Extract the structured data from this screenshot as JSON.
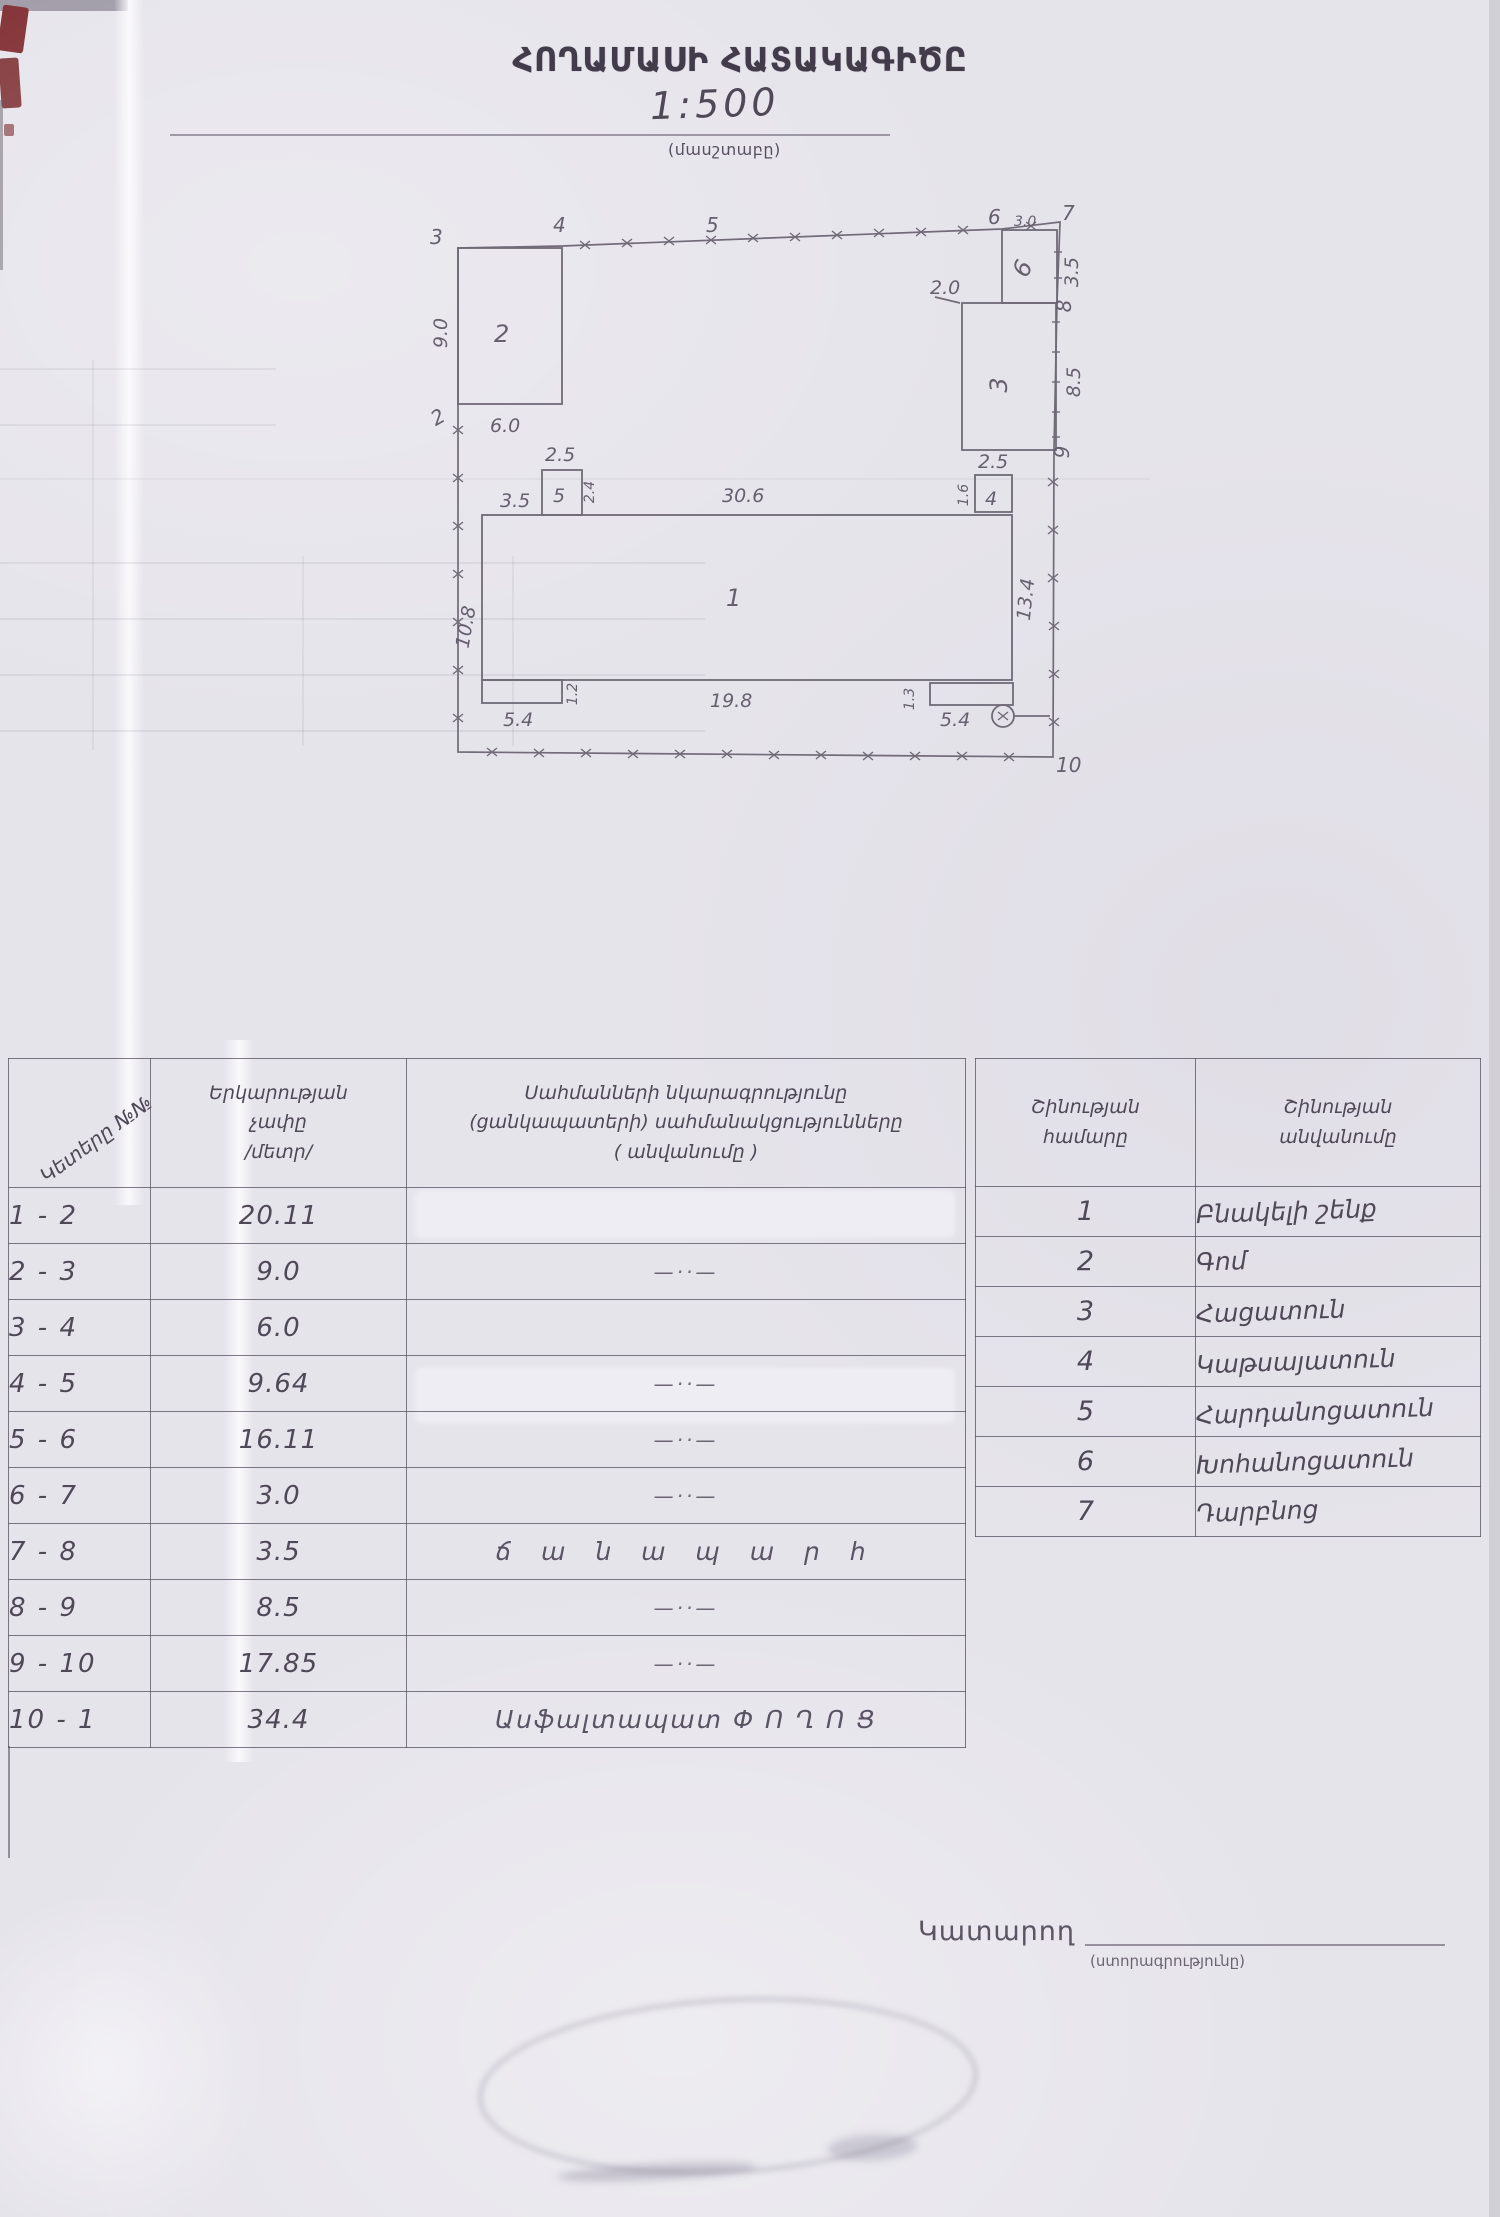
{
  "header": {
    "title": "ՀՈՂԱՄԱՍԻ ՀԱՏԱԿԱԳԻԾԸ",
    "scale": "1:500",
    "scale_caption": "(մասշտաբը)"
  },
  "plan": {
    "points": {
      "p2": "2",
      "p3": "3",
      "p4": "4",
      "p5": "5",
      "p6": "6",
      "p7": "7",
      "p8": "8",
      "p9": "9",
      "p10": "10"
    },
    "buildings": {
      "b1": "1",
      "b2": "2",
      "b3": "3",
      "b4": "4",
      "b5": "5",
      "b6": "6"
    },
    "dims": {
      "left_2_3": "9.0",
      "b2_bottom": "6.0",
      "top_6_7": "3.0",
      "right_7_8": "3.5",
      "right_8_9": "8.5",
      "b3_top": "2.0",
      "b5_width": "2.5",
      "b5_offset": "3.5",
      "b5_height": "2.4",
      "b1_top": "30.6",
      "b4_width": "2.5",
      "b4_height": "1.6",
      "b1_right": "13.4",
      "b1_left": "10.8",
      "porch_left_width": "5.4",
      "porch_left_height": "1.2",
      "b1_bottom": "19.8",
      "porch_right_height": "1.3",
      "porch_right_width": "5.4"
    }
  },
  "table": {
    "left": {
      "h_points": "Կետերը №№",
      "h_len": [
        "Երկարության",
        "չափը",
        "/մետր/"
      ],
      "h_desc": [
        "Սահմանների նկարագրությունը",
        "(ցանկապատերի) սահմանակցությունները",
        "( անվանումը )"
      ],
      "rows": [
        {
          "seg": "1 - 2",
          "len": "20.11",
          "desc": ""
        },
        {
          "seg": "2 - 3",
          "len": "9.0",
          "desc": "—··—"
        },
        {
          "seg": "3 - 4",
          "len": "6.0",
          "desc": ""
        },
        {
          "seg": "4 - 5",
          "len": "9.64",
          "desc": "—··—"
        },
        {
          "seg": "5 - 6",
          "len": "16.11",
          "desc": "—··—"
        },
        {
          "seg": "6 - 7",
          "len": "3.0",
          "desc": "—··—"
        },
        {
          "seg": "7 - 8",
          "len": "3.5",
          "desc": "ճ ա ն ա պ ա ր հ"
        },
        {
          "seg": "8 - 9",
          "len": "8.5",
          "desc": "—··—"
        },
        {
          "seg": "9 - 10",
          "len": "17.85",
          "desc": "—··—"
        },
        {
          "seg": "10 - 1",
          "len": "34.4",
          "desc": "Ասֆալտապատ  Փ Ո Ղ Ո Ց"
        }
      ]
    },
    "right": {
      "h_num": [
        "Շինության",
        "համարը"
      ],
      "h_name": [
        "Շինության",
        "անվանումը"
      ],
      "rows": [
        {
          "num": "1",
          "name": "Բնակելի շենք"
        },
        {
          "num": "2",
          "name": "Գոմ"
        },
        {
          "num": "3",
          "name": "Հացատուն"
        },
        {
          "num": "4",
          "name": "Կաթսայատուն"
        },
        {
          "num": "5",
          "name": "Հարդանոցատուն"
        },
        {
          "num": "6",
          "name": "Խոհանոցատուն"
        },
        {
          "num": "7",
          "name": "Դարբնոց"
        }
      ]
    }
  },
  "footer": {
    "executor": "Կատարող",
    "signature_caption": "(ստորագրությունը)"
  }
}
